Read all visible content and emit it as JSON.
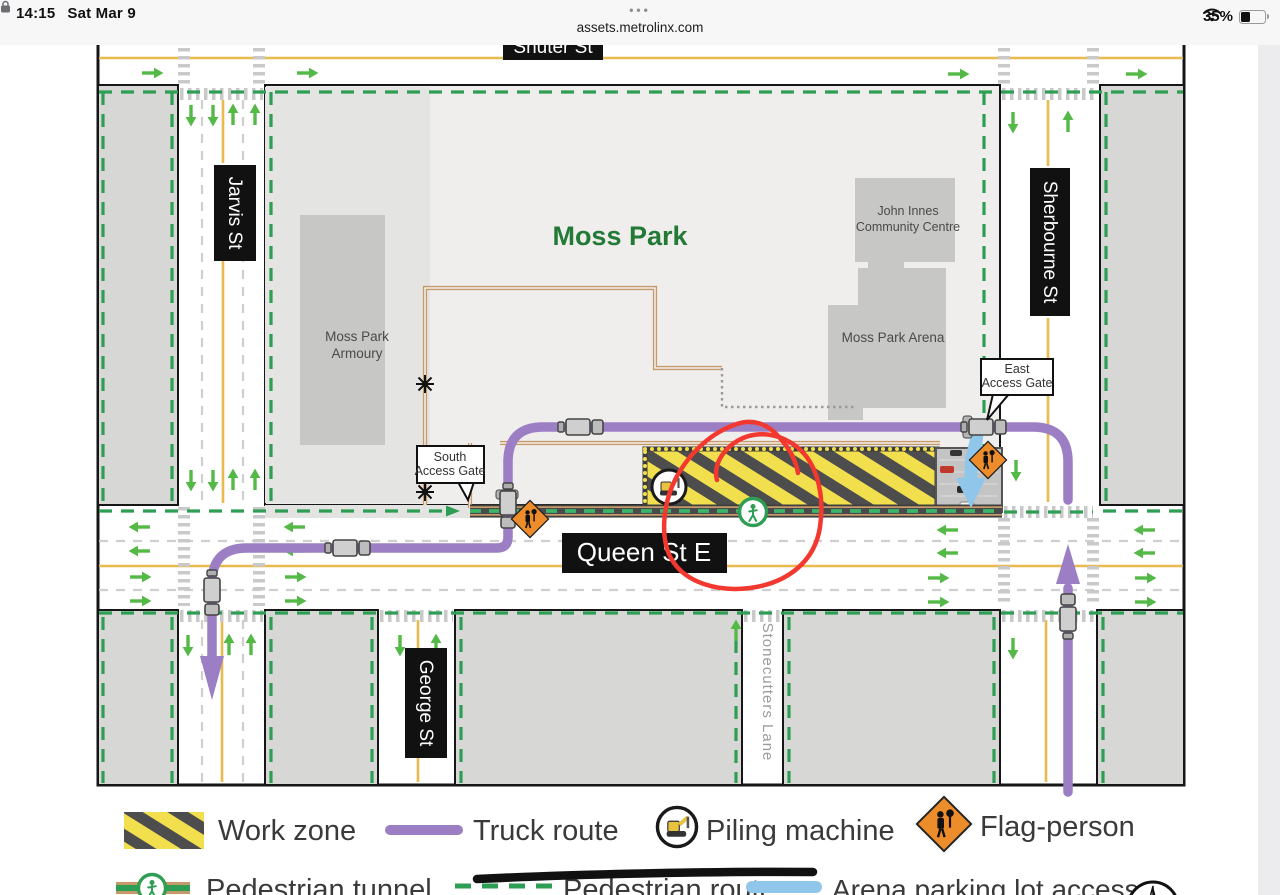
{
  "status_bar": {
    "time": "14:15",
    "date": "Sat Mar 9",
    "menu_dots": "•••",
    "url": "assets.metrolinx.com",
    "battery_percent": "35%"
  },
  "map": {
    "park_label": "Moss Park",
    "streets": {
      "shuter": "Shuter St",
      "jarvis": "Jarvis St",
      "sherbourne": "Sherbourne St",
      "queen": "Queen St E",
      "george": "George St",
      "stonecutters": "Stonecutters Lane"
    },
    "buildings": {
      "armoury_line1": "Moss Park",
      "armoury_line2": "Armoury",
      "john_innes_line1": "John Innes",
      "john_innes_line2": "Community Centre",
      "arena": "Moss Park Arena"
    },
    "gates": {
      "south_line1": "South",
      "south_line2": "Access Gate",
      "east_line1": "East",
      "east_line2": "Access Gate"
    }
  },
  "legend": {
    "work_zone": "Work zone",
    "truck_route": "Truck route",
    "piling_machine": "Piling machine",
    "flag_person": "Flag-person",
    "pedestrian_tunnel": "Pedestrian tunnel",
    "pedestrian_route": "Pedestrian route",
    "arena_access": "Arena parking lot access"
  },
  "colors": {
    "truck_purple": "#9B7EC3",
    "work_zone_yellow": "#F2DF4E",
    "stripe_gray": "#4D4D4D",
    "route_green": "#2E9E54",
    "arrow_green": "#55B948",
    "arena_blue": "#90C6EA",
    "flag_orange": "#ED8C2B",
    "fence_tan": "#C49A6C",
    "annotation_red": "#F3392F",
    "annotation_black": "#111111"
  }
}
